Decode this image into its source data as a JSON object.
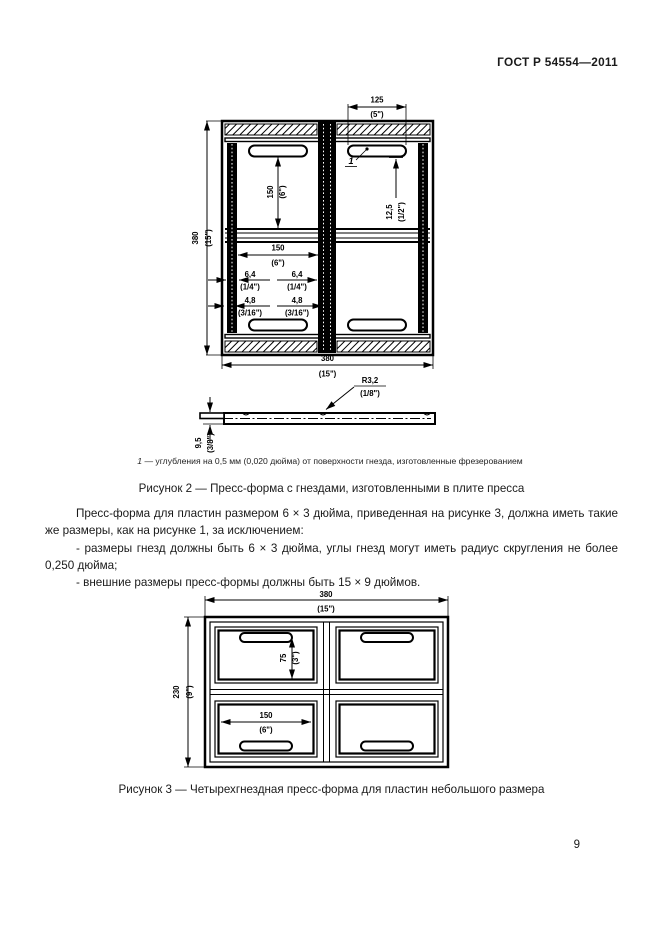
{
  "page": {
    "header": "ГОСТ Р 54554—2011",
    "number": "9"
  },
  "figure2": {
    "callout": "1",
    "footnote_ref": "1",
    "footnote_text": "— углубления на 0,5 мм (0,020 дюйма) от поверхности гнезда, изготовленные фрезерованием",
    "caption": "Рисунок 2 — Пресс-форма с гнездами, изготовленными в плите пресса",
    "dims": {
      "slot_len_mm": "125",
      "slot_len_in": "(5\")",
      "height_mm": "380",
      "height_in": "(15\")",
      "cavity_h_mm": "150",
      "cavity_h_in": "(6\")",
      "slot_offset_mm": "12,5",
      "slot_offset_in": "(1/2\")",
      "cavity_w_mm": "150",
      "cavity_w_in": "(6\")",
      "rib_mm": "6,4",
      "rib_in": "(1/4\")",
      "groove_mm": "4,8",
      "groove_in": "(3/16\")",
      "width_mm": "380",
      "width_in": "(15\")",
      "radius_mm": "R3,2",
      "radius_in": "(1/8\")",
      "depth_mm": "9,5",
      "depth_in": "(3/8\")"
    }
  },
  "text1": {
    "para": "Пресс-форма для пластин размером 6 × 3 дюйма, приведенная на рисунке 3, должна иметь такие же размеры, как на рисунке 1, за исключением:",
    "item1": "- размеры гнезд должны быть 6 × 3 дюйма, углы гнезд могут иметь радиус скругления не более 0,250 дюйма;",
    "item2": "- внешние размеры пресс-формы должны быть 15 × 9 дюймов."
  },
  "figure3": {
    "caption": "Рисунок 3 — Четырехгнездная пресс-форма для пластин небольшого размера",
    "dims": {
      "width_mm": "380",
      "width_in": "(15\")",
      "height_mm": "230",
      "height_in": "(9\")",
      "cavity_h_mm": "75",
      "cavity_h_in": "(3\")",
      "cavity_w_mm": "150",
      "cavity_w_in": "(6\")"
    }
  }
}
